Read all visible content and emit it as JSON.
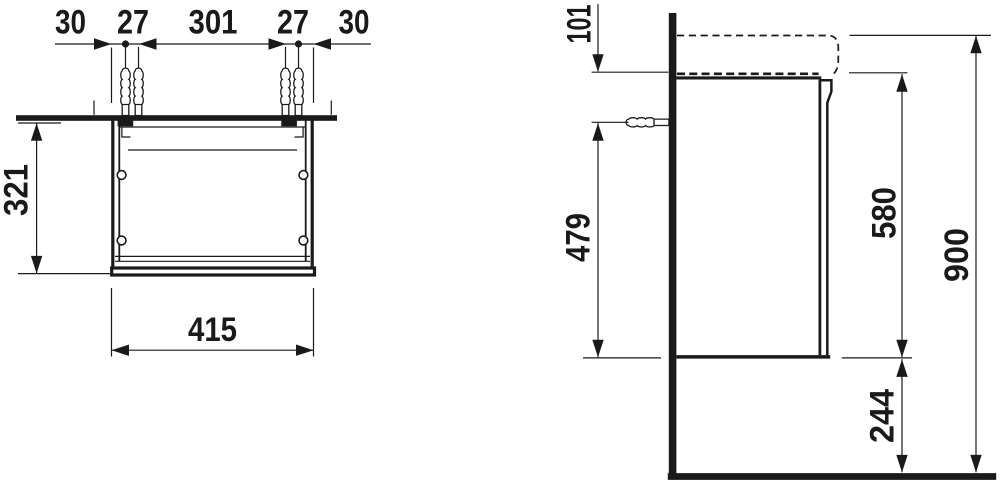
{
  "drawing": {
    "background_color": "#ffffff",
    "line_color": "#1a1a1a",
    "plan_view": {
      "dim_30_left": "30",
      "dim_27_left": "27",
      "dim_301": "301",
      "dim_27_right": "27",
      "dim_30_right": "30",
      "dim_depth": "321",
      "dim_width": "415"
    },
    "side_view": {
      "dim_top_offset": "101",
      "dim_fixing_height": "479",
      "dim_body_height": "580",
      "dim_total_height": "900",
      "dim_bottom_clearance": "244"
    }
  }
}
